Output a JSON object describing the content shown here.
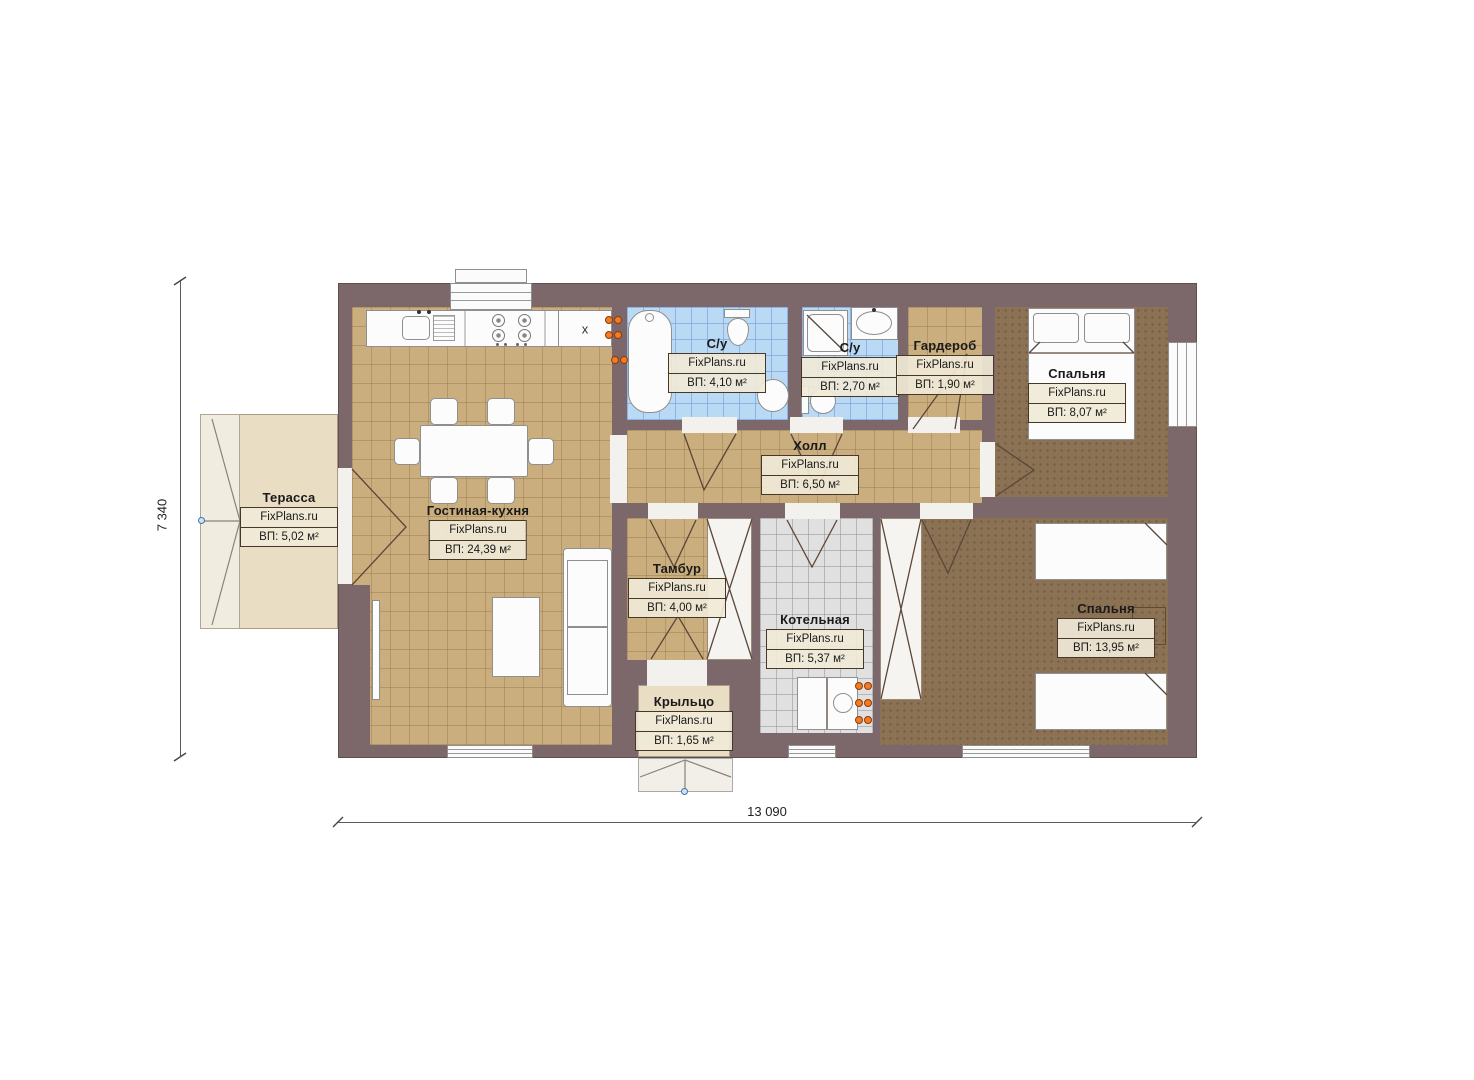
{
  "plan": {
    "brand": "FixPlans.ru",
    "dimension_width": "13 090",
    "dimension_height": "7 340",
    "kitchen_cabinet_label": "x",
    "rooms": [
      {
        "name": "Терасса",
        "area": "ВП: 5,02 м²"
      },
      {
        "name": "Гостиная-кухня",
        "area": "ВП: 24,39 м²"
      },
      {
        "name": "С/у",
        "area": "ВП: 4,10 м²"
      },
      {
        "name": "С/у",
        "area": "ВП: 2,70 м²"
      },
      {
        "name": "Гардероб",
        "area": "ВП: 1,90 м²"
      },
      {
        "name": "Спальня",
        "area": "ВП: 8,07 м²"
      },
      {
        "name": "Холл",
        "area": "ВП: 6,50 м²"
      },
      {
        "name": "Тамбур",
        "area": "ВП: 4,00 м²"
      },
      {
        "name": "Котельная",
        "area": "ВП: 5,37 м²"
      },
      {
        "name": "Спальня",
        "area": "ВП: 13,95 м²"
      },
      {
        "name": "Крыльцо",
        "area": "ВП: 1,65 м²"
      }
    ],
    "colors": {
      "wall": "#7c686a",
      "floor_tile_tan": "#cbae7e",
      "floor_bedroom": "#8b7254",
      "floor_bath": "#b9d9f4",
      "floor_boiler": "#e0e0e0",
      "terrace": "#e9ddc4",
      "radiator_orange": "#f57b20",
      "marker_blue": "#3f74a8"
    }
  }
}
